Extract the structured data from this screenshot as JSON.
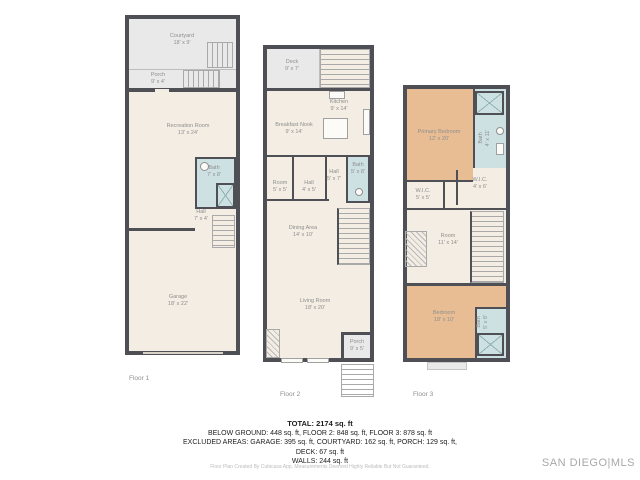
{
  "watermark": "SAN DIEGO|MLS",
  "summary": {
    "total": "TOTAL: 2174 sq. ft",
    "line_floors": "BELOW GROUND: 448 sq. ft, FLOOR 2: 848 sq. ft, FLOOR 3: 878 sq. ft",
    "line_excluded": "EXCLUDED AREAS: GARAGE: 395 sq. ft, COURTYARD: 162 sq. ft, PORCH: 129 sq. ft,",
    "line_deck": "DECK: 67 sq. ft",
    "line_walls": "WALLS: 244 sq. ft",
    "disclaimer": "Floor Plan Created By Cubicasa App. Measurements Deemed Highly Reliable But Not Guaranteed."
  },
  "colors": {
    "wall": "#4f5056",
    "floor": "#f3ede3",
    "outdoor": "#e9e9e9",
    "bath": "#cde1e2",
    "bedroom": "#e9bd93",
    "label_text": "#8f8f8f"
  },
  "floors": [
    {
      "label": "Floor 1",
      "rooms": {
        "courtyard": {
          "name": "Courtyard",
          "dims": "18' x 9'"
        },
        "porch": {
          "name": "Porch",
          "dims": "9' x 4'"
        },
        "recreation_room": {
          "name": "Recreation Room",
          "dims": "13' x 24'"
        },
        "bath": {
          "name": "Bath",
          "dims": "7' x 8'"
        },
        "hall": {
          "name": "Hall",
          "dims": "7' x 4'"
        },
        "garage": {
          "name": "Garage",
          "dims": "18' x 22'"
        }
      }
    },
    {
      "label": "Floor 2",
      "rooms": {
        "deck": {
          "name": "Deck",
          "dims": "9' x 7'"
        },
        "kitchen": {
          "name": "Kitchen",
          "dims": "9' x 14'"
        },
        "breakfast_nook": {
          "name": "Breakfast Nook",
          "dims": "9' x 14'"
        },
        "room": {
          "name": "Room",
          "dims": "5' x 5'"
        },
        "hall": {
          "name": "Hall",
          "dims": "4' x 5'"
        },
        "hall2": {
          "name": "Hall",
          "dims": "5' x 7'"
        },
        "bath": {
          "name": "Bath",
          "dims": "5' x 8'"
        },
        "dining_area": {
          "name": "Dining Area",
          "dims": "14' x 10'"
        },
        "living_room": {
          "name": "Living Room",
          "dims": "18' x 20'"
        },
        "porch": {
          "name": "Porch",
          "dims": "9' x 5'"
        }
      }
    },
    {
      "label": "Floor 3",
      "rooms": {
        "primary_bedroom": {
          "name": "Primary Bedroom",
          "dims": "12' x 20'"
        },
        "bath_top": {
          "name": "Bath",
          "dims": "4' x 11'"
        },
        "wic_left": {
          "name": "W.I.C.",
          "dims": "5' x 5'"
        },
        "wic_right": {
          "name": "W.I.C.",
          "dims": "4' x 6'"
        },
        "room": {
          "name": "Room",
          "dims": "11' x 14'"
        },
        "bedroom": {
          "name": "Bedroom",
          "dims": "18' x 10'"
        },
        "bath_bottom": {
          "name": "Bath",
          "dims": "5' x 8'"
        }
      }
    }
  ]
}
